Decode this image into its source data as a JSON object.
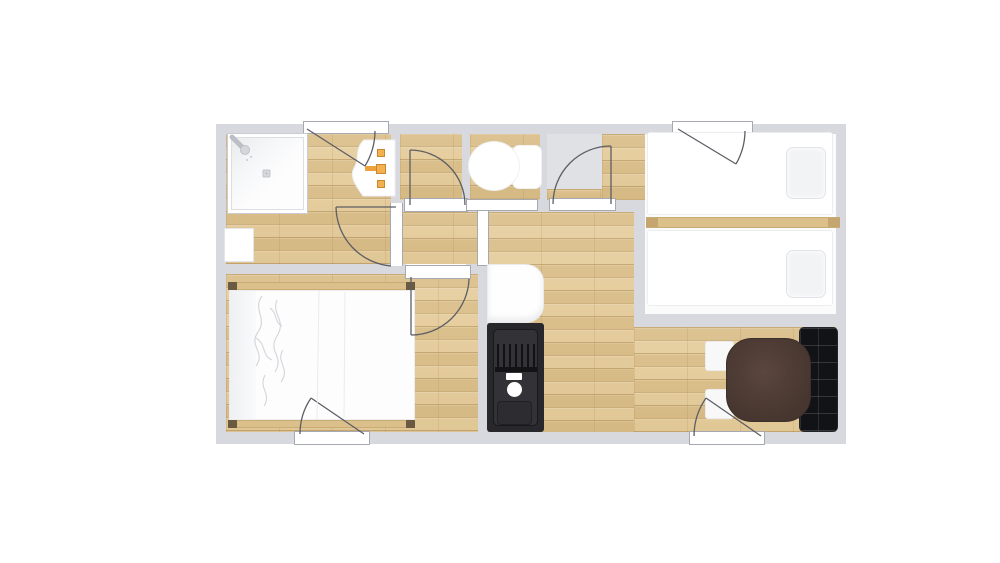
{
  "plan": {
    "type": "apartment-floor-plan",
    "colors": {
      "background": "#ffffff",
      "wall": "#d7d9de",
      "wood_floor": "#e2c894",
      "tile_floor": "#dfe1e5",
      "white_floor": "#fbfbfc",
      "door_line": "#5d5e64",
      "faucet_accent": "#eda23b",
      "sofa": "#121316",
      "kitchen_unit": "#28282c",
      "dining_table": "#4a3a33",
      "bed_frame": "#dcc08c"
    },
    "rooms": [
      {
        "id": "bathroom",
        "floor": "wood",
        "features": [
          "shower",
          "washbasin",
          "storage-box"
        ]
      },
      {
        "id": "closet",
        "floor": "wood",
        "features": []
      },
      {
        "id": "wc",
        "floor": "wood",
        "features": [
          "toilet"
        ]
      },
      {
        "id": "vestibule",
        "floor": "tile",
        "features": []
      },
      {
        "id": "hallway",
        "floor": "wood",
        "features": []
      },
      {
        "id": "twin-bedroom",
        "floor": "white",
        "features": [
          "twin-bed-1",
          "twin-bed-2",
          "pillow",
          "pillow",
          "headboard-divider"
        ]
      },
      {
        "id": "master-bedroom",
        "floor": "wood",
        "features": [
          "double-bed"
        ]
      },
      {
        "id": "kitchenette",
        "floor": "wood",
        "features": [
          "kitchen-sink-unit",
          "white-appliance"
        ]
      },
      {
        "id": "dining-area",
        "floor": "wood",
        "features": [
          "dining-table",
          "stool",
          "stool",
          "tufted-sofa"
        ]
      }
    ],
    "doors": [
      {
        "id": "entry-door-top"
      },
      {
        "id": "twin-bedroom-door"
      },
      {
        "id": "bathroom-door"
      },
      {
        "id": "closet-door"
      },
      {
        "id": "wc-doorway"
      },
      {
        "id": "vestibule-door"
      },
      {
        "id": "master-bedroom-door"
      },
      {
        "id": "master-bedroom-exterior-door"
      },
      {
        "id": "dining-exterior-door"
      },
      {
        "id": "hall-cased-opening"
      }
    ]
  }
}
